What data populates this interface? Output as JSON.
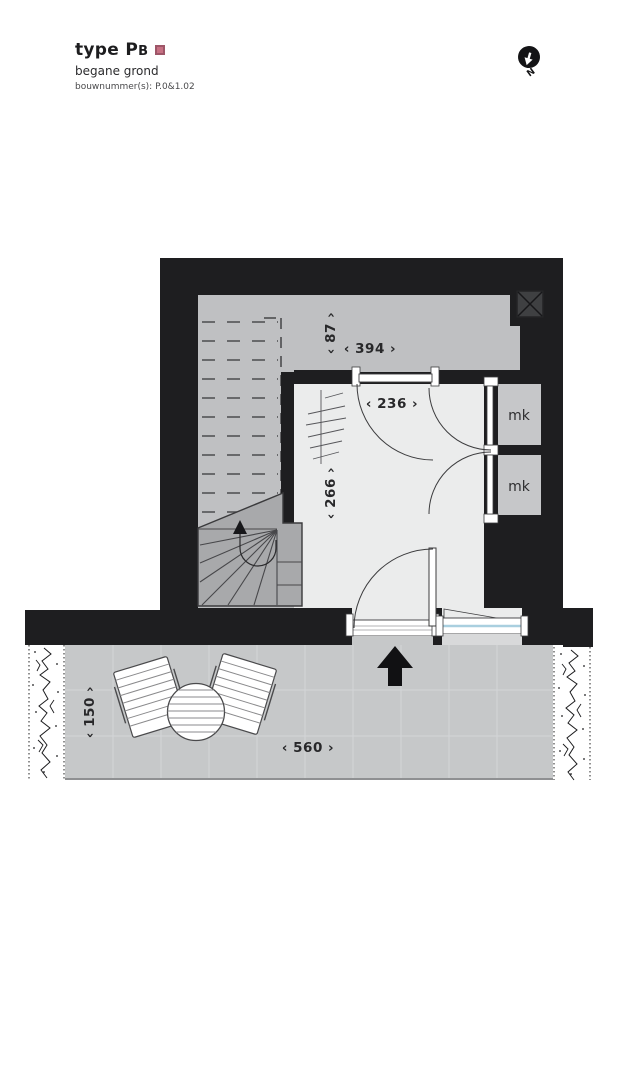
{
  "header": {
    "title_main": "type P",
    "title_small": "B",
    "subtitle": "begane grond",
    "build_numbers": "bouwnummer(s): P.0&1.02",
    "accent_color": "#c77183"
  },
  "compass": {
    "north_label": "N"
  },
  "plan": {
    "rooms": {
      "mk_top": "mk",
      "mk_bottom": "mk"
    },
    "dimensions": {
      "upper_depth": "‹ 87 ›",
      "upper_width": "‹ 394 ›",
      "hall_width": "‹ 236 ›",
      "hall_depth": "‹ 266 ›",
      "terrace_depth": "‹ 150 ›",
      "terrace_width": "‹ 560 ›"
    },
    "colors": {
      "wall": "#1e1e20",
      "upper_floor": "#bfc0c2",
      "hall_floor": "#ebecec",
      "stair": "#a8a9ab",
      "mk_floor": "#c6c7c9",
      "terrace": "#c6c8c9",
      "glazing": "#a9cfdf",
      "dimension_text": "#28282a"
    }
  }
}
